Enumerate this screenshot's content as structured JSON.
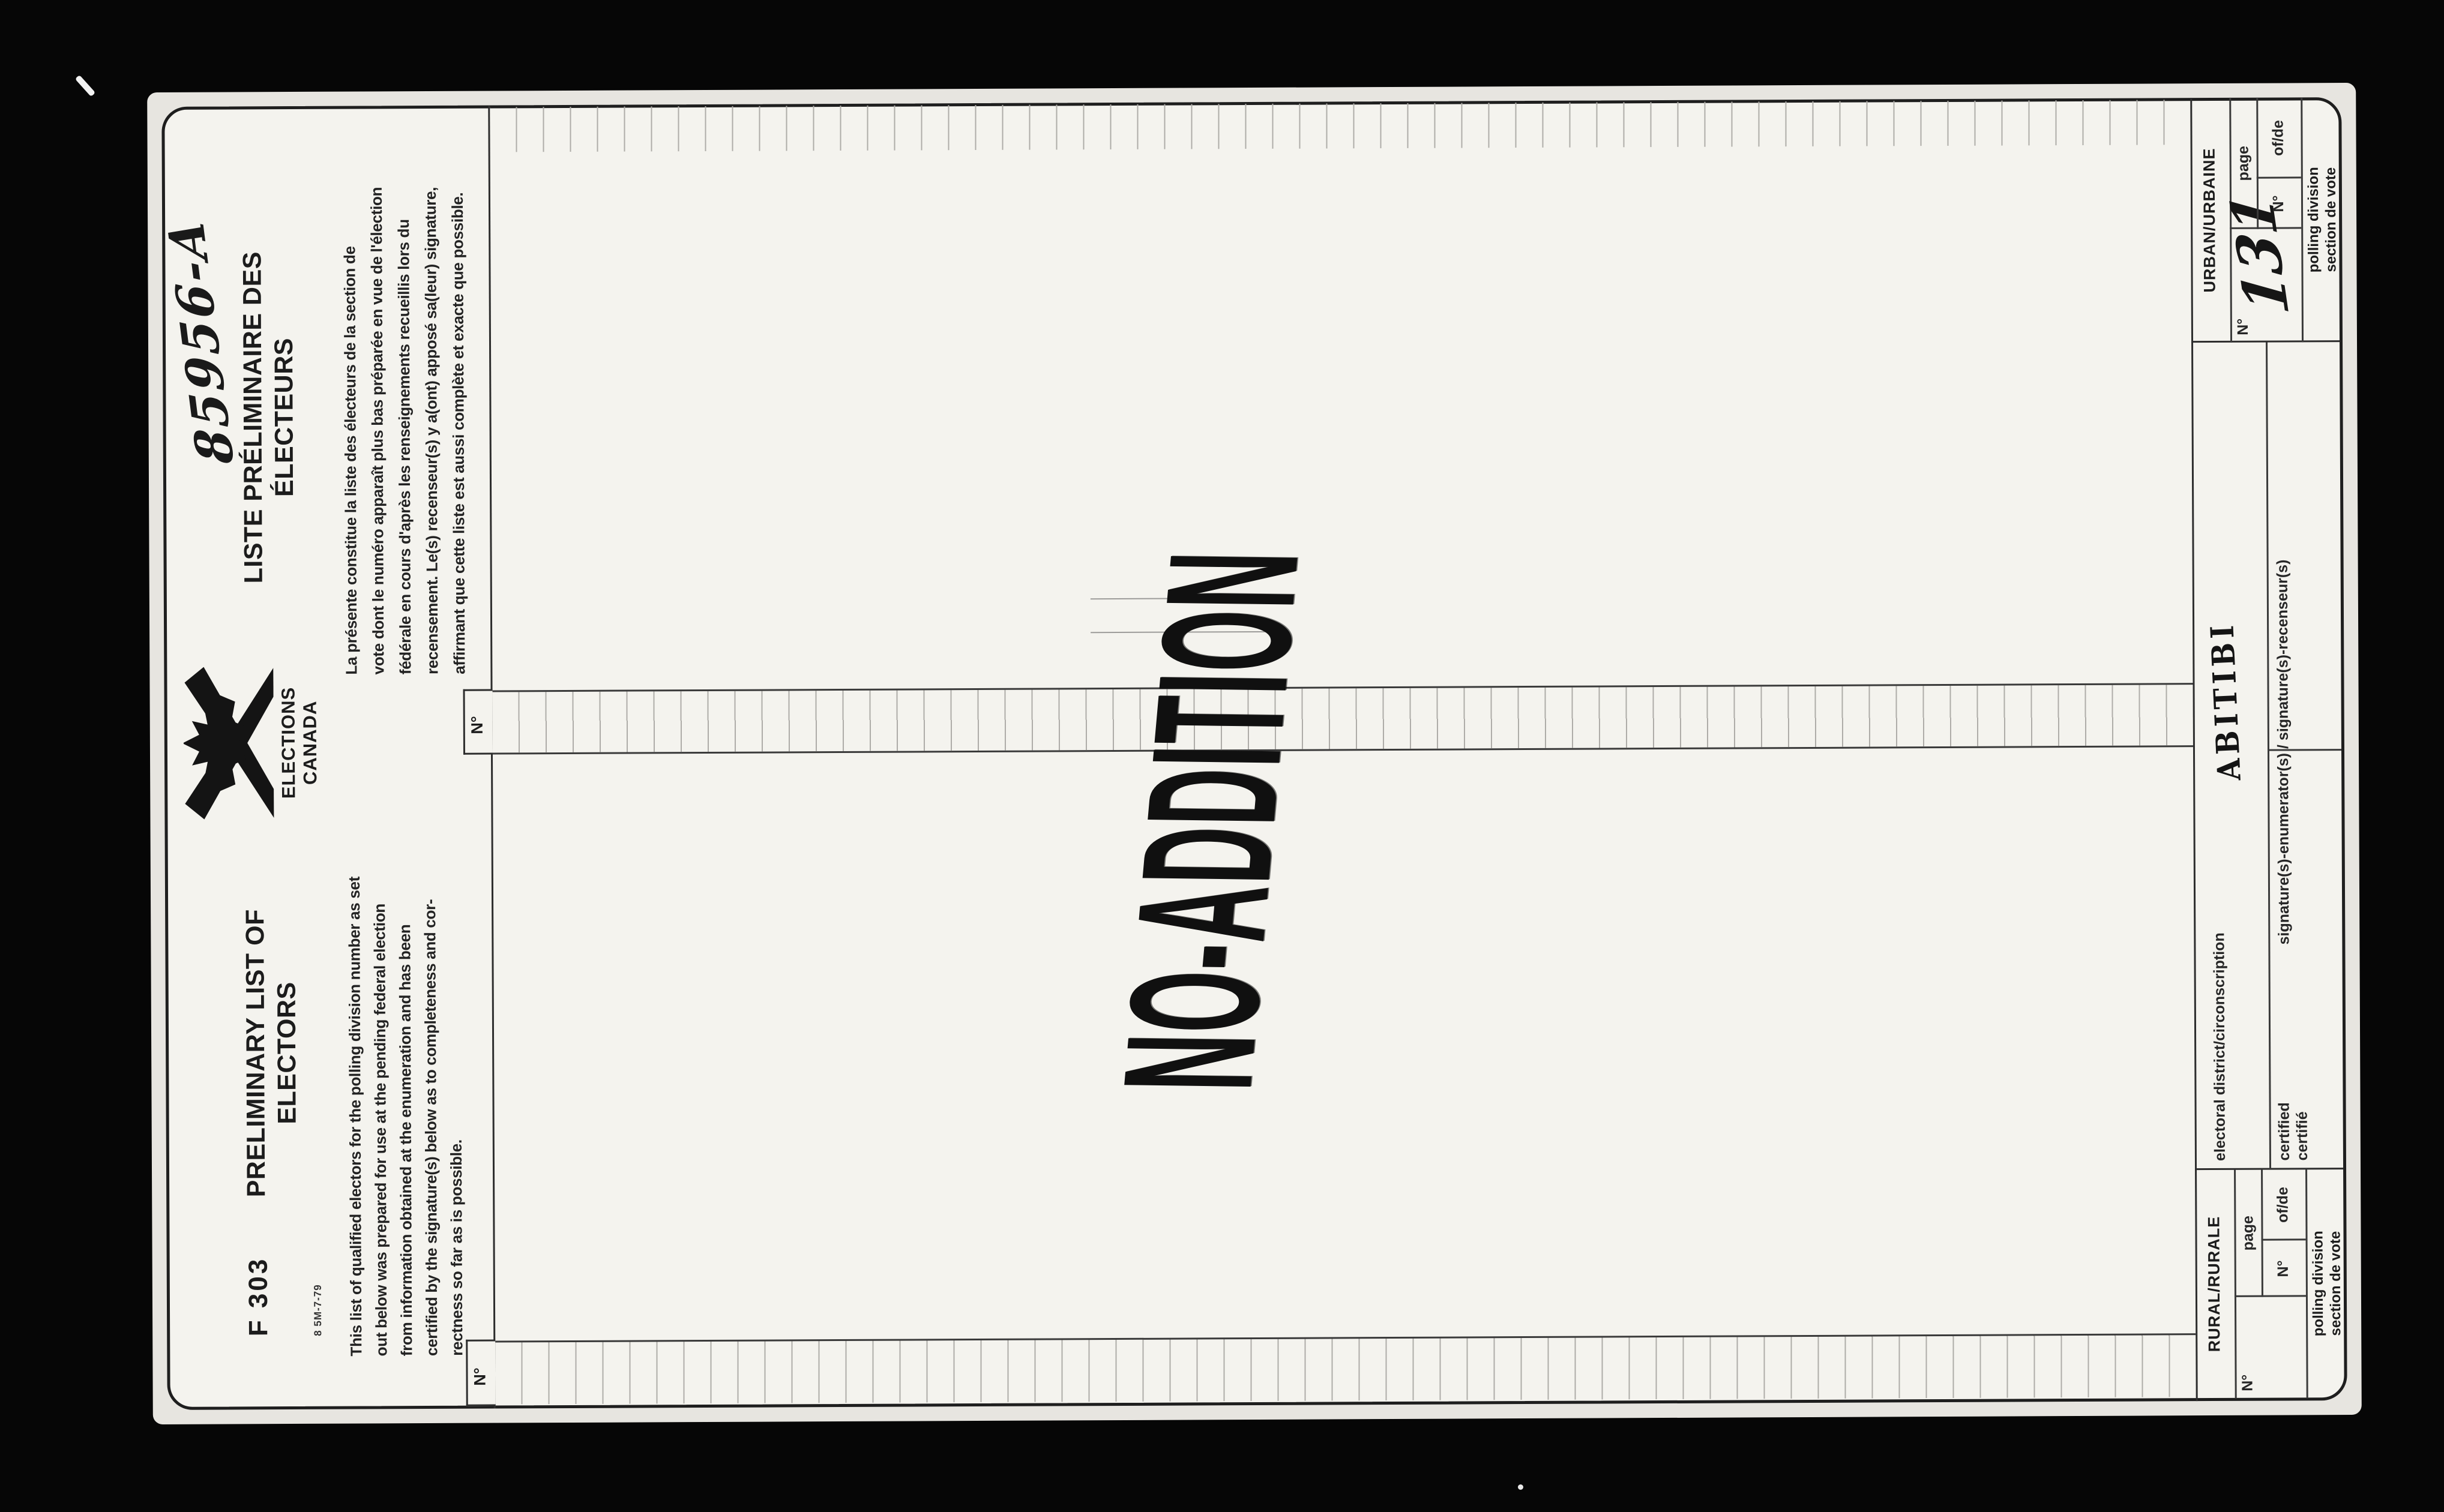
{
  "page": {
    "handwritten_number": "85956-A",
    "form_code": "F 303",
    "print_code": "8 5M-7-79",
    "title_en": {
      "line1": "PRELIMINARY LIST OF",
      "line2": "ELECTORS"
    },
    "title_fr": {
      "line1": "LISTE PRÉLIMINAIRE DES",
      "line2": "ÉLECTEURS"
    },
    "logo": {
      "line1": "ELECTIONS",
      "line2": "CANADA",
      "icon": "elections-canada-x-maple-leaf"
    },
    "paragraph_en": {
      "lines": [
        "This list of qualified electors for the polling division number as set",
        "out below was prepared for use at the pending federal election",
        "from information obtained at the enumeration and has been",
        "certified by the signature(s) below as to completeness and cor-",
        "rectness so far as is possible."
      ]
    },
    "paragraph_fr": {
      "lines": [
        "La présente constitue la liste des électeurs de la section de",
        "vote dont le numéro apparaît plus bas préparée en vue de l'élection",
        "fédérale en cours d'après les renseignements recueillis lors du",
        "recensement. Le(s) recenseur(s) y a(ont) apposé sa(leur) signature,",
        "affirmant que cette liste est aussi complète et exacte que possible."
      ]
    },
    "list": {
      "col1_header": "N°",
      "col2_header": "N°"
    },
    "stamp": "NO-ADDITION",
    "footer": {
      "rural": {
        "title": "RURAL/RURALE",
        "big_no": "N°",
        "page": "page",
        "page_no": "N°",
        "of_de": "of/de",
        "polling1": "polling division",
        "polling2": "section de vote"
      },
      "urban": {
        "title": "URBAN/URBAINE",
        "big_no": "N°",
        "page": "page",
        "page_no": "N°",
        "of_de": "of/de",
        "polling1": "polling division",
        "polling2": "section de vote",
        "polling_value": "131"
      },
      "district_label": "electoral district/circonscription",
      "district_value": "ABITIBI",
      "certified_en": "certified",
      "certified_fr": "certifié",
      "signature_label": "signature(s)-enumerator(s) / signature(s)-recenseur(s)"
    }
  }
}
